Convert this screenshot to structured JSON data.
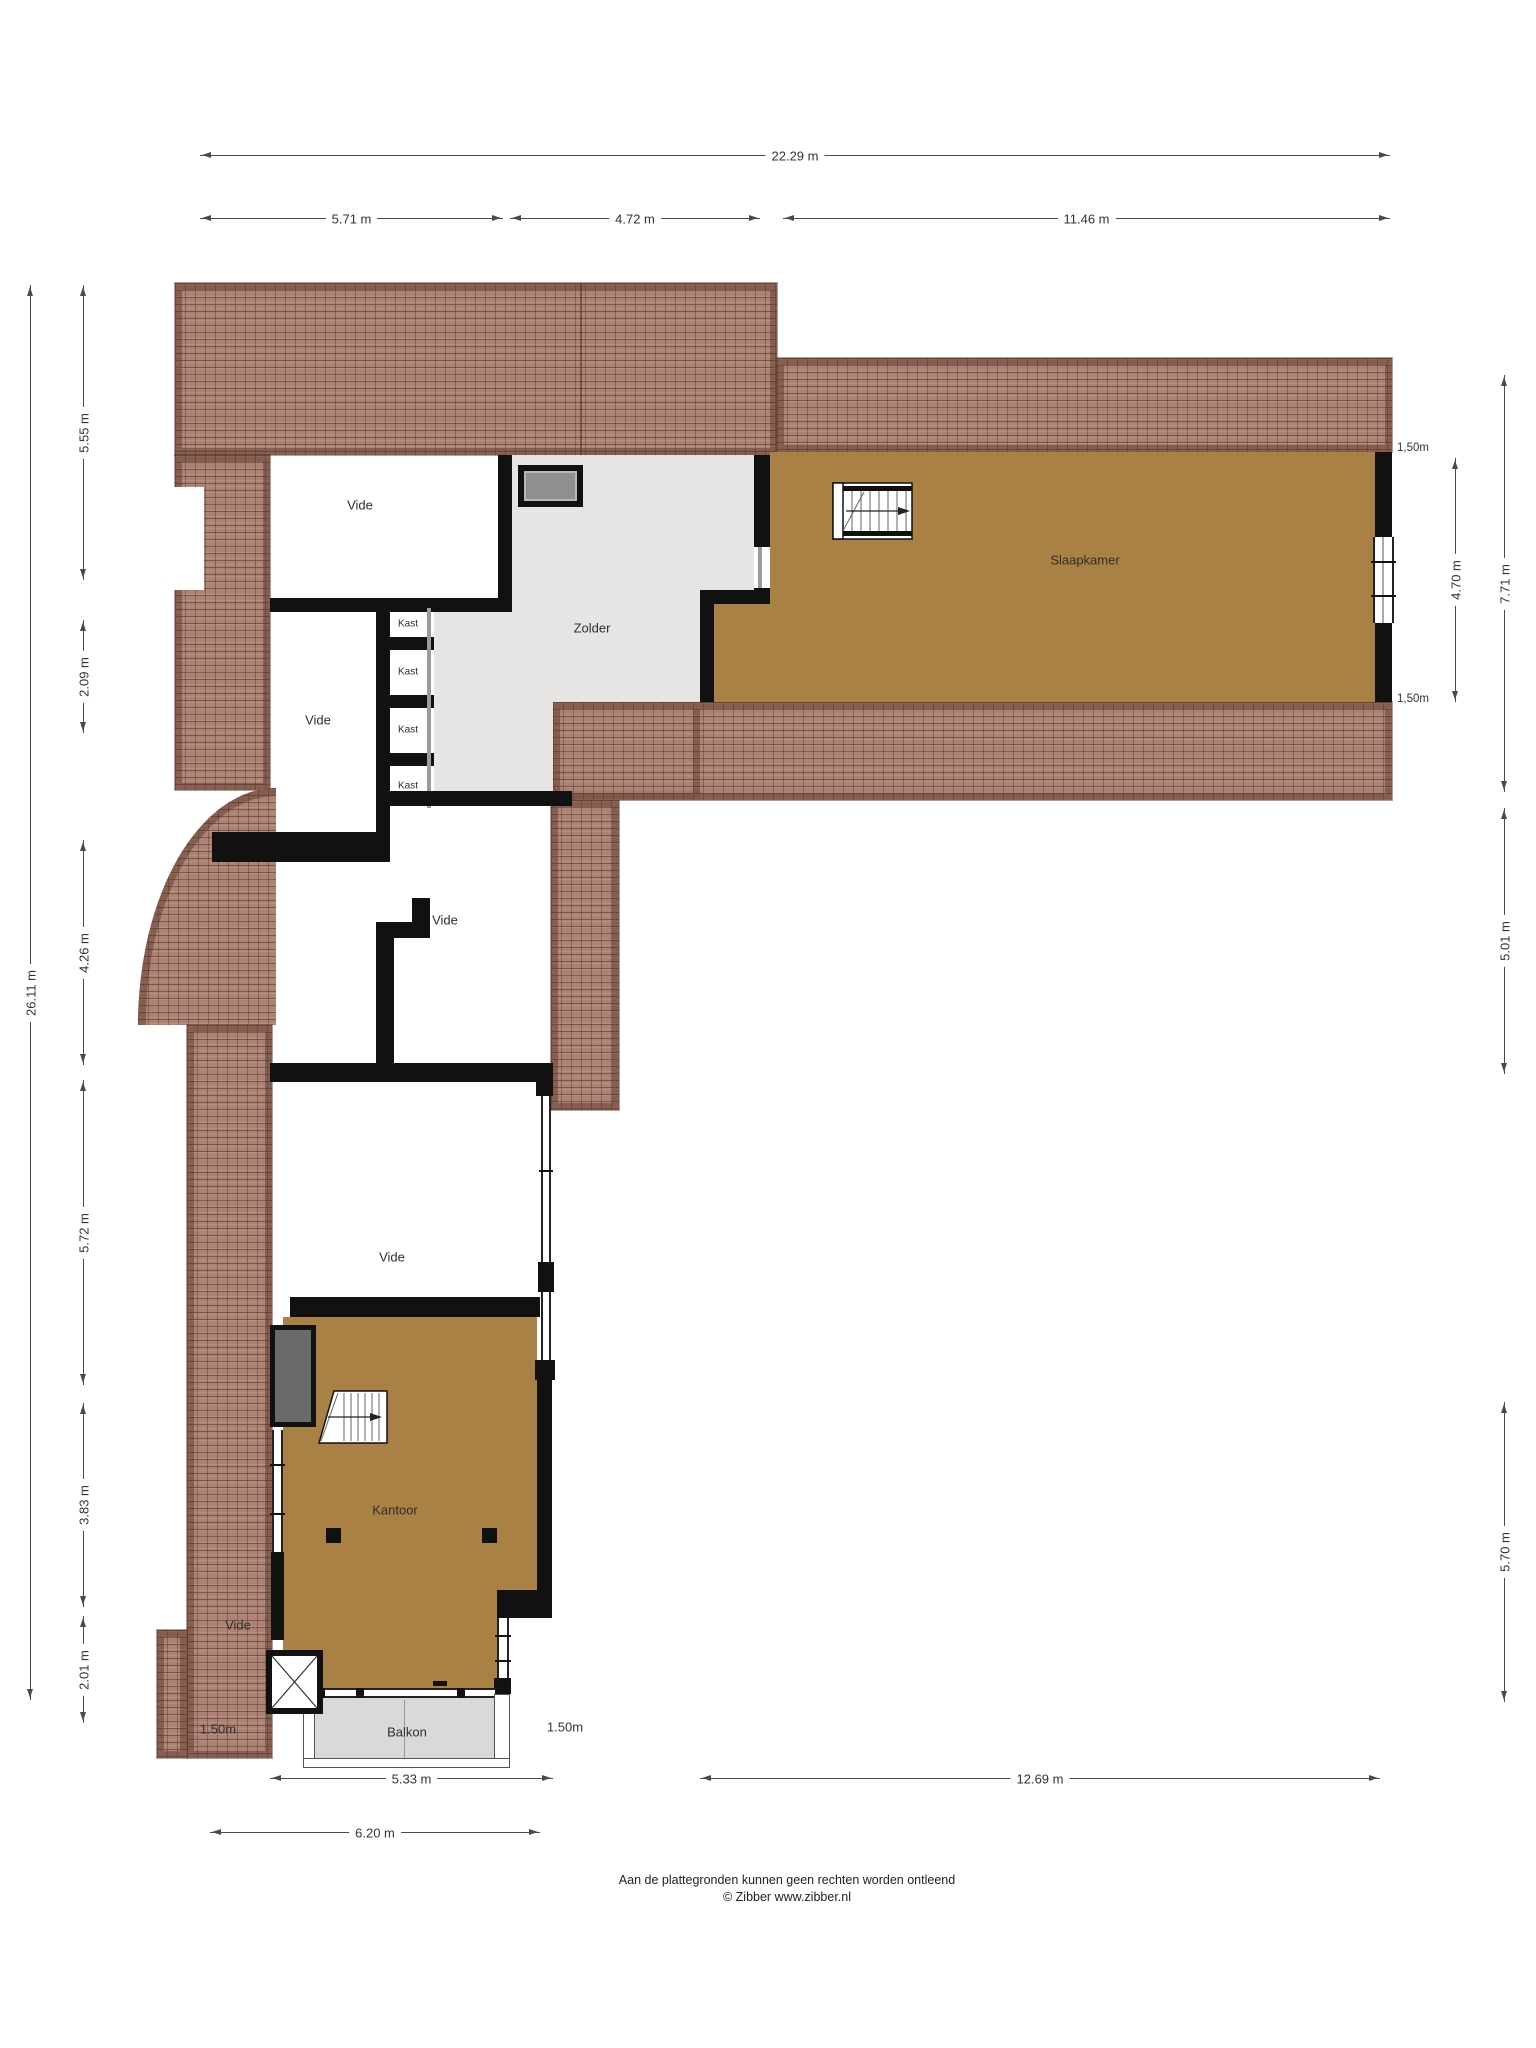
{
  "rooms": {
    "vide1": "Vide",
    "vide2": "Vide",
    "vide3": "Vide",
    "vide3b": "Vide",
    "vide4": "Vide",
    "zolder": "Zolder",
    "slaapkamer": "Slaapkamer",
    "kantoor": "Kantoor",
    "balkon": "Balkon",
    "kast1": "Kast",
    "kast2": "Kast",
    "kast3": "Kast",
    "kast4": "Kast"
  },
  "dimensions": {
    "top_total": "22.29 m",
    "top_left": "5.71 m",
    "top_mid": "4.72 m",
    "top_right": "11.46 m",
    "left_total": "26.11 m",
    "left_1": "5.55 m",
    "left_2": "2.09 m",
    "left_3": "4.26 m",
    "left_4": "5.72 m",
    "left_5": "3.83 m",
    "left_6": "2.01 m",
    "right_roof_top": "1,50m",
    "right_roof_bottom": "1,50m",
    "right_inner": "4.70 m",
    "right_wing": "7.71 m",
    "right_mid": "5.01 m",
    "right_lower": "5.70 m",
    "balcony_left": "1.50m",
    "balcony_right": "1.50m",
    "bottom_balcony": "5.33 m",
    "bottom_wing": "12.69 m",
    "bottom_total": "6.20 m"
  },
  "footer": {
    "line1": "Aan de plattegronden kunnen geen rechten worden ontleend",
    "line2": "© Zibber www.zibber.nl"
  },
  "colors": {
    "roof_tile": "#a77a6a",
    "roof_line": "#5f4434",
    "wall": "#111111",
    "wood_floor": "#a98144",
    "attic_floor": "#e6e5e3",
    "balcony_floor": "#d9d9d9",
    "dimension_line": "#4a4a4a"
  }
}
